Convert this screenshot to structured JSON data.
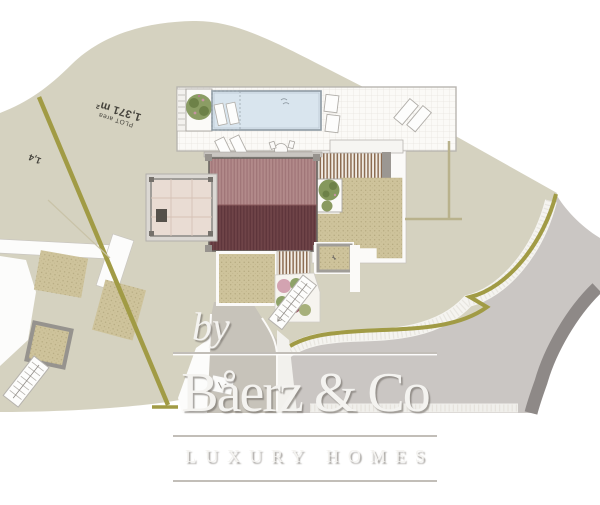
{
  "site_plan": {
    "plot_label": {
      "title": "PLOT area",
      "area": "1,371 m²"
    },
    "neighbor_label_fragment": "1,4",
    "colors": {
      "plot_fill": "#d5d2c0",
      "boundary_olive": "#a19b45",
      "road_gray": "#cac6c3",
      "curb_dark": "#8e8987",
      "roof_upper": "#b28a8a",
      "roof_lower": "#6f4448",
      "pool_blue": "#d9e5ee",
      "terrace_tan": "#cec39b",
      "gravel_white": "#f5f4f0"
    }
  },
  "watermark": {
    "prefix": "by",
    "brand": "Båerz & Co",
    "tagline": "LUXURY HOMES"
  }
}
